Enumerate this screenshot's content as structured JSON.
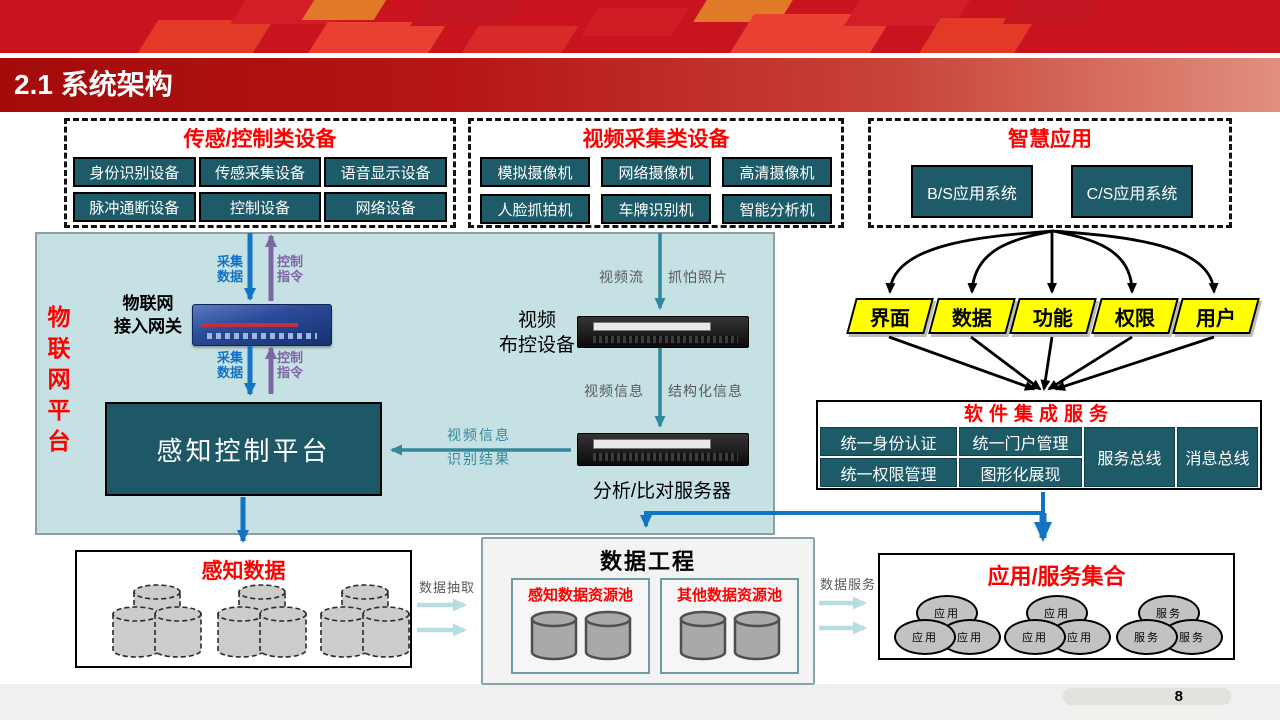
{
  "header": {
    "title": "2.1 系统架构"
  },
  "device_groups": {
    "sensor": {
      "title": "传感/控制类设备",
      "items": [
        "身份识别设备",
        "传感采集设备",
        "语音显示设备",
        "脉冲通断设备",
        "控制设备",
        "网络设备"
      ]
    },
    "video": {
      "title": "视频采集类设备",
      "items": [
        "模拟摄像机",
        "网络摄像机",
        "高清摄像机",
        "人脸抓拍机",
        "车牌识别机",
        "智能分析机"
      ]
    },
    "smart_app": {
      "title": "智慧应用",
      "items": [
        "B/S应用系统",
        "C/S应用系统"
      ]
    }
  },
  "iot_platform": {
    "side_label": "物联网平台",
    "gateway_label": "物联网\n接入网关",
    "perception_platform": "感知控制平台",
    "video_device_label": "视频\n布控设备",
    "analysis_server_label": "分析/比对服务器",
    "flows": {
      "collect": "采集\n数据",
      "control": "控制\n指令",
      "video_stream": "视频流",
      "capture_photo": "抓怕照片",
      "video_info": "视频信息",
      "structured_info": "结构化信息",
      "video_info2": "视频信息",
      "recognition_result": "识别结果"
    }
  },
  "integration": {
    "aspects": [
      "界面",
      "数据",
      "功能",
      "权限",
      "用户"
    ],
    "title": "软件集成服务",
    "cells": {
      "r1c1": "统一身份认证",
      "r1c2": "统一门户管理",
      "r2c1": "统一权限管理",
      "r2c2": "图形化展现",
      "bus1": "服务总线",
      "bus2": "消息总线"
    }
  },
  "bottom": {
    "perception_data": {
      "title": "感知数据"
    },
    "data_engineering": {
      "title": "数据工程",
      "pools": [
        "感知数据资源池",
        "其他数据资源池"
      ]
    },
    "app_service": {
      "title": "应用/服务集合",
      "cluster_labels": [
        "应用",
        "应用",
        "服务"
      ]
    },
    "extract_label": "数据抽取",
    "service_label": "数据服务"
  },
  "footer": {
    "page": "8"
  },
  "colors": {
    "accent_red": "#ff0000",
    "banner_red": "#c9131f",
    "teal_item": "#1e5b69",
    "platform_bg": "#c6e1e3",
    "parallelogram_yellow": "#ffff00",
    "arrow_blue": "#1474c4",
    "arrow_purple": "#7d66a6",
    "arrow_teal": "#35879b",
    "arrow_pale": "#b7dce2"
  }
}
